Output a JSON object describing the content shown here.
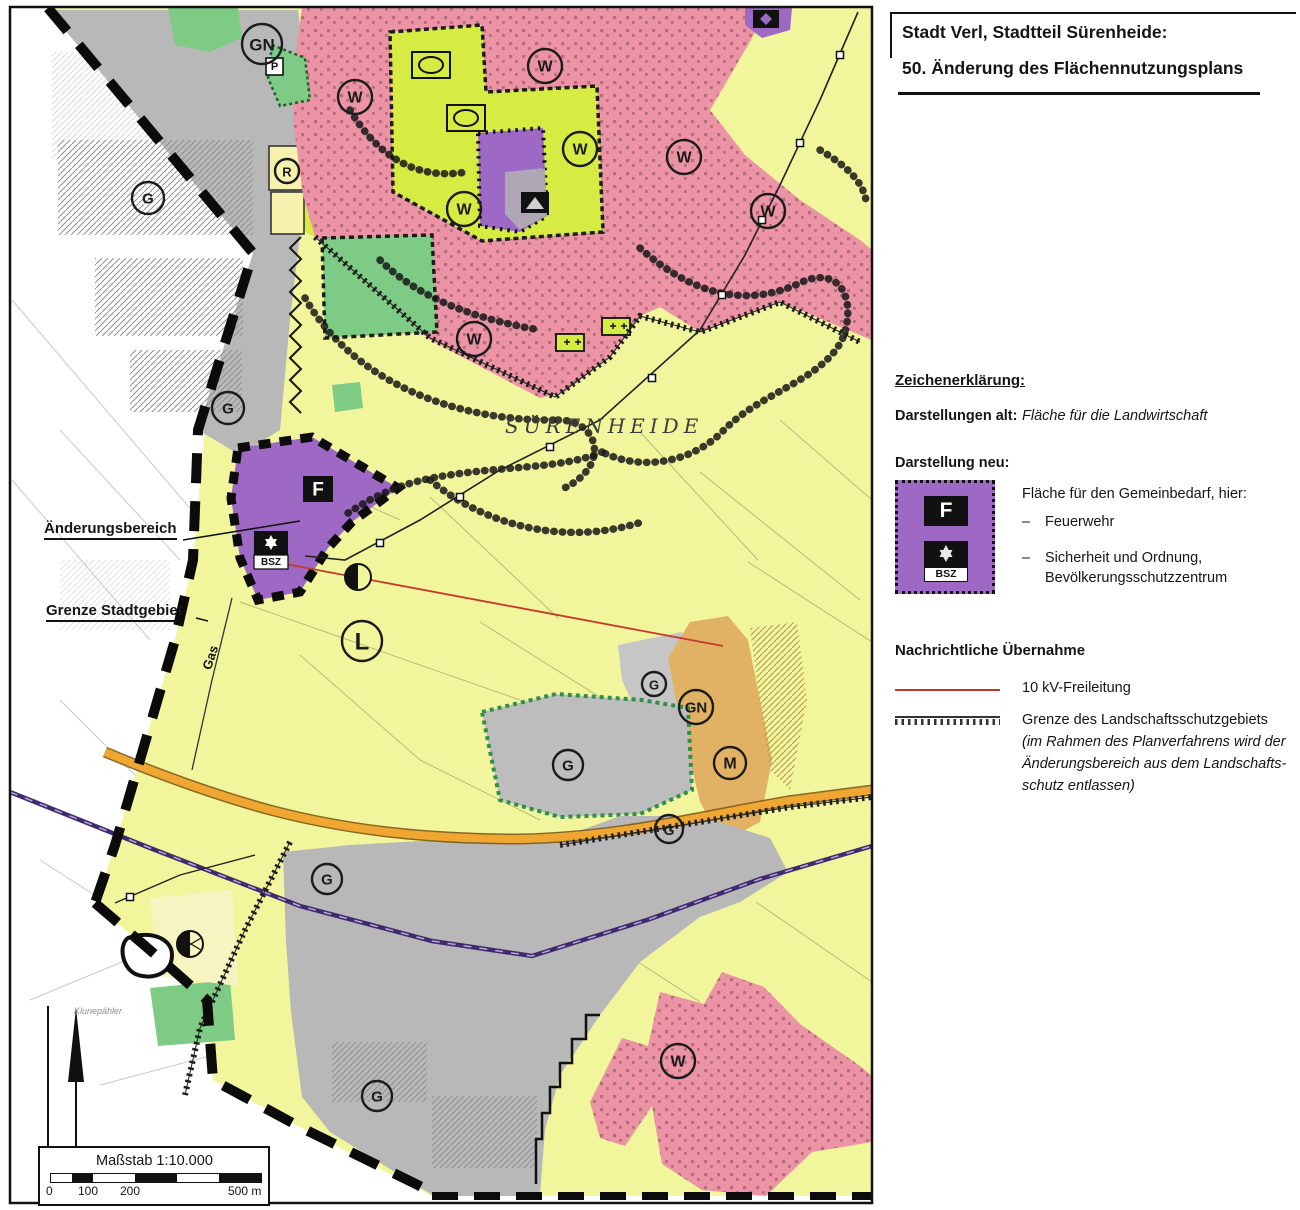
{
  "title": {
    "line1": "Stadt Verl, Stadtteil Sürenheide:",
    "line2": "50. Änderung des Flächennutzungsplans"
  },
  "legend": {
    "heading": "Zeichenerklärung:",
    "old_label": "Darstellungen alt:",
    "old_value": "Fläche für die Landwirtschaft",
    "new_label": "Darstellung neu:",
    "dash": "–",
    "gemeinbedarf": {
      "title": "Fläche für den Gemeinbedarf, hier:",
      "item1": "Feuerwehr",
      "item2a": "Sicherheit und Ordnung,",
      "item2b": "Bevölkerungsschutzzentrum",
      "symbol_f": "F",
      "symbol_bsz": "BSZ"
    },
    "nachrichtlich": {
      "heading": "Nachrichtliche Übernahme",
      "item1": "10 kV-Freileitung",
      "item2": "Grenze des Landschaftsschutzgebiets",
      "note1": "(im Rahmen des Planverfahrens wird der",
      "note2": "Änderungsbereich aus dem Landschafts-",
      "note3": "schutz entlassen)"
    }
  },
  "map": {
    "place": "SÜRENHEIDE",
    "aenderungsbereich": "Änderungsbereich",
    "grenze_stadtgebiet": "Grenze Stadtgebiet",
    "gas": "Gas",
    "klunepaehler": "Klunepähler",
    "symbol_f": "F",
    "symbol_bsz": "BSZ",
    "symbol_p": "P",
    "scale_label": "Maßstab 1:10.000",
    "scale_t0": "0",
    "scale_t1": "100",
    "scale_t2": "200",
    "scale_t3": "500 m",
    "zone_labels": [
      {
        "t": "GN",
        "x": 262,
        "y": 44,
        "r": 20,
        "fs": 17
      },
      {
        "t": "G",
        "x": 148,
        "y": 198,
        "r": 16,
        "fs": 15
      },
      {
        "t": "G",
        "x": 228,
        "y": 408,
        "r": 16,
        "fs": 15
      },
      {
        "t": "W",
        "x": 355,
        "y": 97,
        "r": 17,
        "fs": 16
      },
      {
        "t": "W",
        "x": 545,
        "y": 66,
        "r": 17,
        "fs": 16
      },
      {
        "t": "W",
        "x": 580,
        "y": 149,
        "r": 17,
        "fs": 16
      },
      {
        "t": "W",
        "x": 684,
        "y": 157,
        "r": 17,
        "fs": 16
      },
      {
        "t": "W",
        "x": 768,
        "y": 211,
        "r": 17,
        "fs": 16
      },
      {
        "t": "W",
        "x": 464,
        "y": 209,
        "r": 17,
        "fs": 16
      },
      {
        "t": "W",
        "x": 474,
        "y": 339,
        "r": 17,
        "fs": 16
      },
      {
        "t": "R",
        "x": 287,
        "y": 171,
        "r": 12,
        "fs": 13
      },
      {
        "t": "L",
        "x": 362,
        "y": 641,
        "r": 20,
        "fs": 24
      },
      {
        "t": "G",
        "x": 654,
        "y": 684,
        "r": 12,
        "fs": 13
      },
      {
        "t": "GN",
        "x": 696,
        "y": 707,
        "r": 17,
        "fs": 15
      },
      {
        "t": "M",
        "x": 730,
        "y": 763,
        "r": 16,
        "fs": 16
      },
      {
        "t": "G",
        "x": 669,
        "y": 829,
        "r": 14,
        "fs": 14
      },
      {
        "t": "G",
        "x": 568,
        "y": 765,
        "r": 15,
        "fs": 15
      },
      {
        "t": "G",
        "x": 327,
        "y": 879,
        "r": 15,
        "fs": 15
      },
      {
        "t": "G",
        "x": 377,
        "y": 1096,
        "r": 15,
        "fs": 15
      },
      {
        "t": "W",
        "x": 678,
        "y": 1061,
        "r": 17,
        "fs": 16
      }
    ]
  },
  "colors": {
    "agriculture_yellow": "#f1f59b",
    "residential_pink": "#ec93a6",
    "industrial_gray": "#b8b8b8",
    "sports_lime": "#d6ec43",
    "green_space": "#7dcb84",
    "gemeinbedarf_purple": "#9e68c5",
    "mixed_use_tan": "#e2b264",
    "road_orange": "#f0a731",
    "railway_violet": "#3f2a6e",
    "power_line_red": "#c6392b"
  }
}
